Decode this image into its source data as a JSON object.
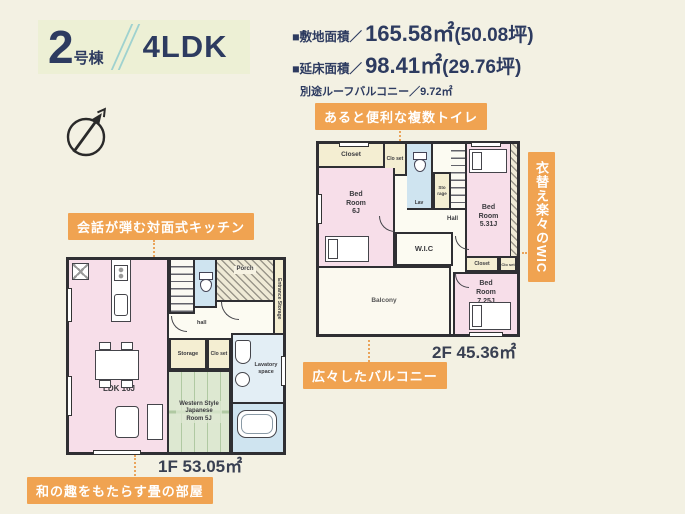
{
  "header": {
    "building_number": "2",
    "building_suffix": "号棟",
    "layout_type": "4LDK"
  },
  "areas": {
    "land_label": "■敷地面積／",
    "land_value": "165.58㎡",
    "land_tsubo": "(50.08坪)",
    "floor_label": "■延床面積／",
    "floor_value": "98.41㎡",
    "floor_tsubo": "(29.76坪)",
    "note": "別途ルーフバルコニー／9.72㎡"
  },
  "callouts": {
    "toilet": "あると便利な複数トイレ",
    "kitchen": "会話が弾む対面式キッチン",
    "wic": "衣替え楽々のWIC",
    "balcony": "広々したバルコニー",
    "tatami": "和の趣をもたらす畳の部屋"
  },
  "floor2": {
    "area_label": "2F 45.36㎡",
    "rooms": {
      "closet_top": "Closet",
      "closet_top_small": "Clo set",
      "bedroom_left": "Bed Room 6J",
      "lav": "Lav",
      "storage": "Sto rage",
      "hall": "Hall",
      "wic": "W.I.C",
      "bedroom_right_top": "Bed Room 5.31J",
      "closet_mid": "Closet",
      "closet_mid_small": "Clo set",
      "bedroom_right_bottom": "Bed Room 7.25J",
      "balcony": "Balcony"
    }
  },
  "floor1": {
    "area_label": "1F 53.05㎡",
    "rooms": {
      "ldk": "LDK 16J",
      "porch": "Porch",
      "hall": "hall",
      "storage": "Storage",
      "closet": "Clo set",
      "entrance_storage": "Entrance Storage",
      "tatami": "Western Style Japanese Room 5J",
      "lavatory": "Lavatory space"
    }
  },
  "colors": {
    "background": "#f3f1e3",
    "accent_orange": "#f0a351",
    "navy": "#2d3b60",
    "room_pink": "#f7dee9",
    "room_cream": "#f4eed2",
    "room_blue": "#cfe4f0",
    "room_green": "#dde8d1"
  }
}
